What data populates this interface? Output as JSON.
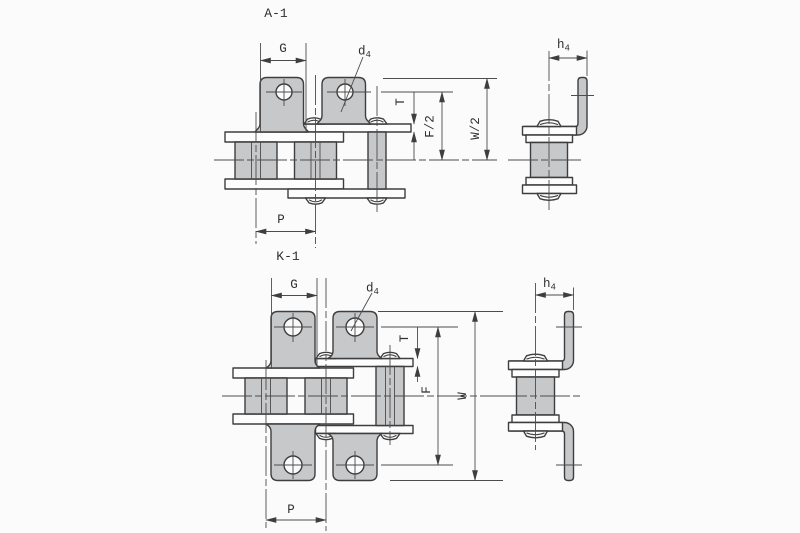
{
  "drawing": {
    "a1": {
      "title": "A-1",
      "dim_g": "G",
      "dim_d4_base": "d",
      "dim_d4_sub": "4",
      "dim_t": "T",
      "dim_f_half": "F/2",
      "dim_w_half": "W/2",
      "dim_h4_base": "h",
      "dim_h4_sub": "4",
      "dim_p": "P"
    },
    "k1": {
      "title": "K-1",
      "dim_g": "G",
      "dim_d4_base": "d",
      "dim_d4_sub": "4",
      "dim_t": "T",
      "dim_f": "F",
      "dim_w": "W",
      "dim_h4_base": "h",
      "dim_h4_sub": "4",
      "dim_p": "P"
    },
    "colors": {
      "part_fill": "#c7c8ca",
      "line": "#3e3e3e",
      "background": "#fbfbfb"
    }
  }
}
